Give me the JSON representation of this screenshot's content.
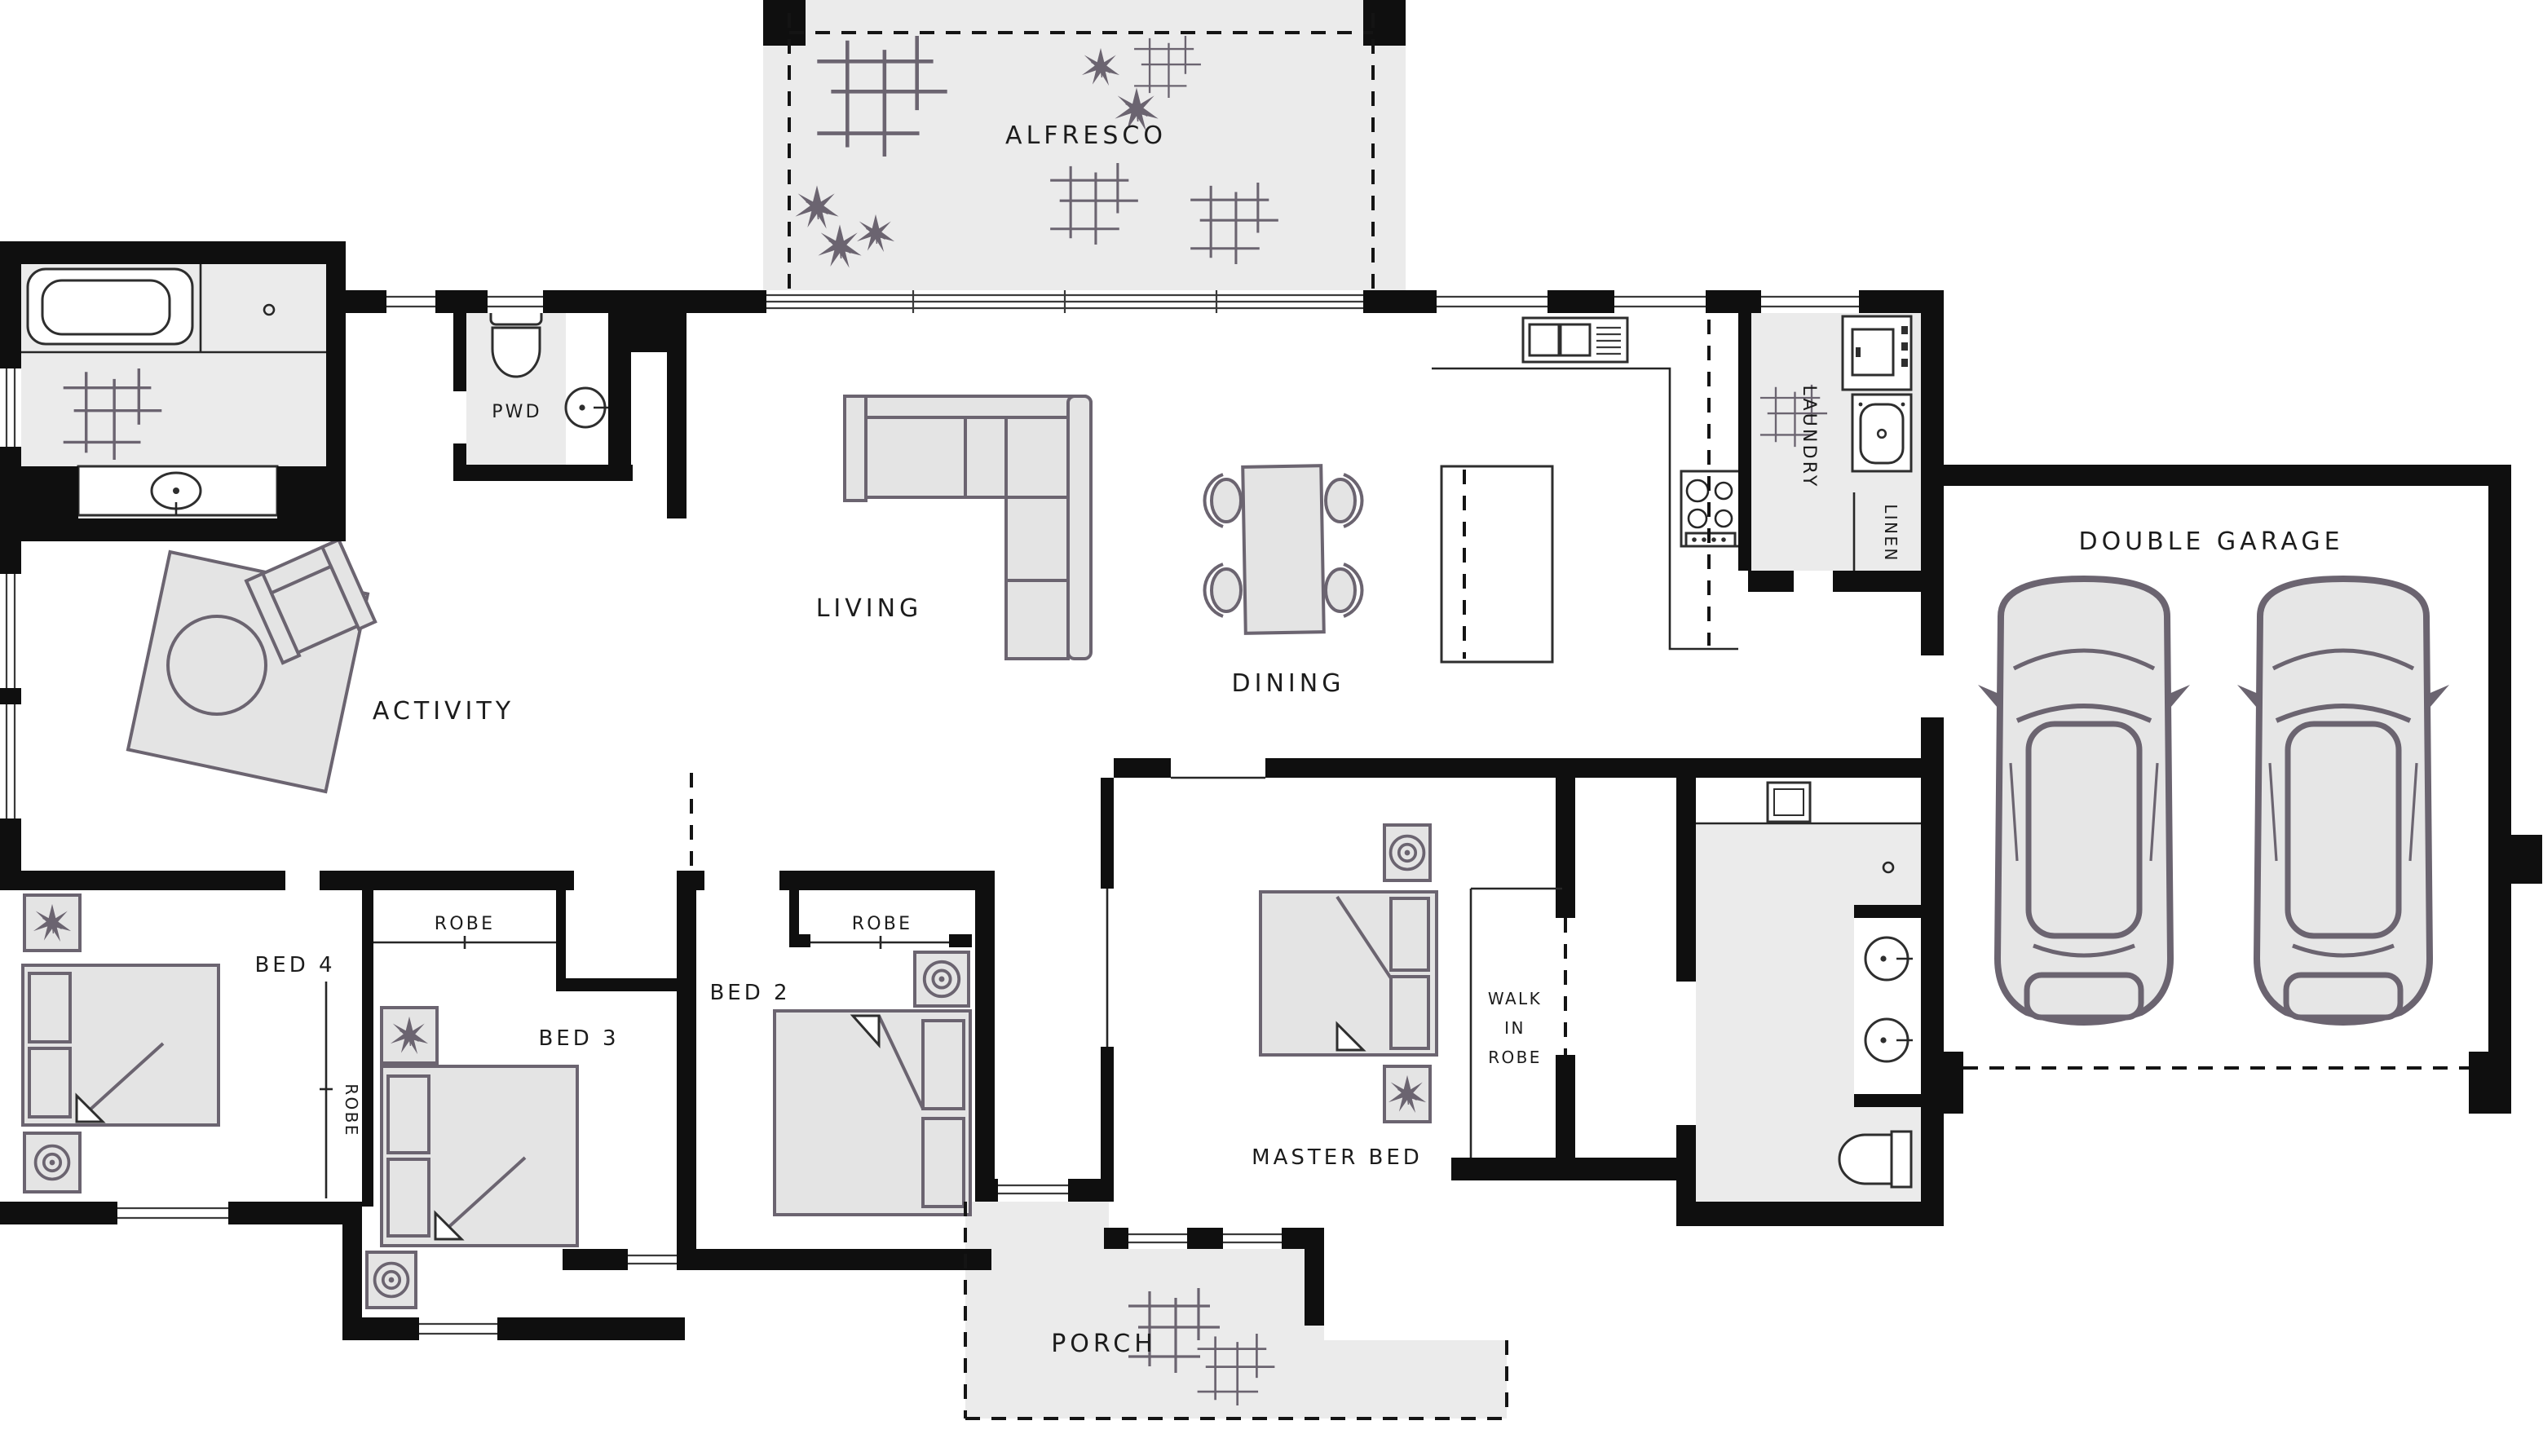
{
  "plan": {
    "title": "Single storey house floor plan",
    "rooms": {
      "alfresco": "ALFRESCO",
      "pwd": "PWD",
      "living": "LIVING",
      "dining": "DINING",
      "laundry": "LAUNDRY",
      "linen": "LINEN",
      "garage": "DOUBLE GARAGE",
      "activity": "ACTIVITY",
      "bed4": "BED 4",
      "robe_bed4": "ROBE",
      "bed3": "BED 3",
      "robe_bed3": "ROBE",
      "bed2": "BED 2",
      "robe_bed2": "ROBE",
      "master": "MASTER BED",
      "wir_line1": "WALK",
      "wir_line2": "IN",
      "wir_line3": "ROBE",
      "porch": "PORCH"
    },
    "colors": {
      "wall": "#0f0f0f",
      "shade": "#ebebeb",
      "furn": "#6b6470",
      "furnfill": "#e4e4e4",
      "ink": "#1c1c1c"
    }
  }
}
